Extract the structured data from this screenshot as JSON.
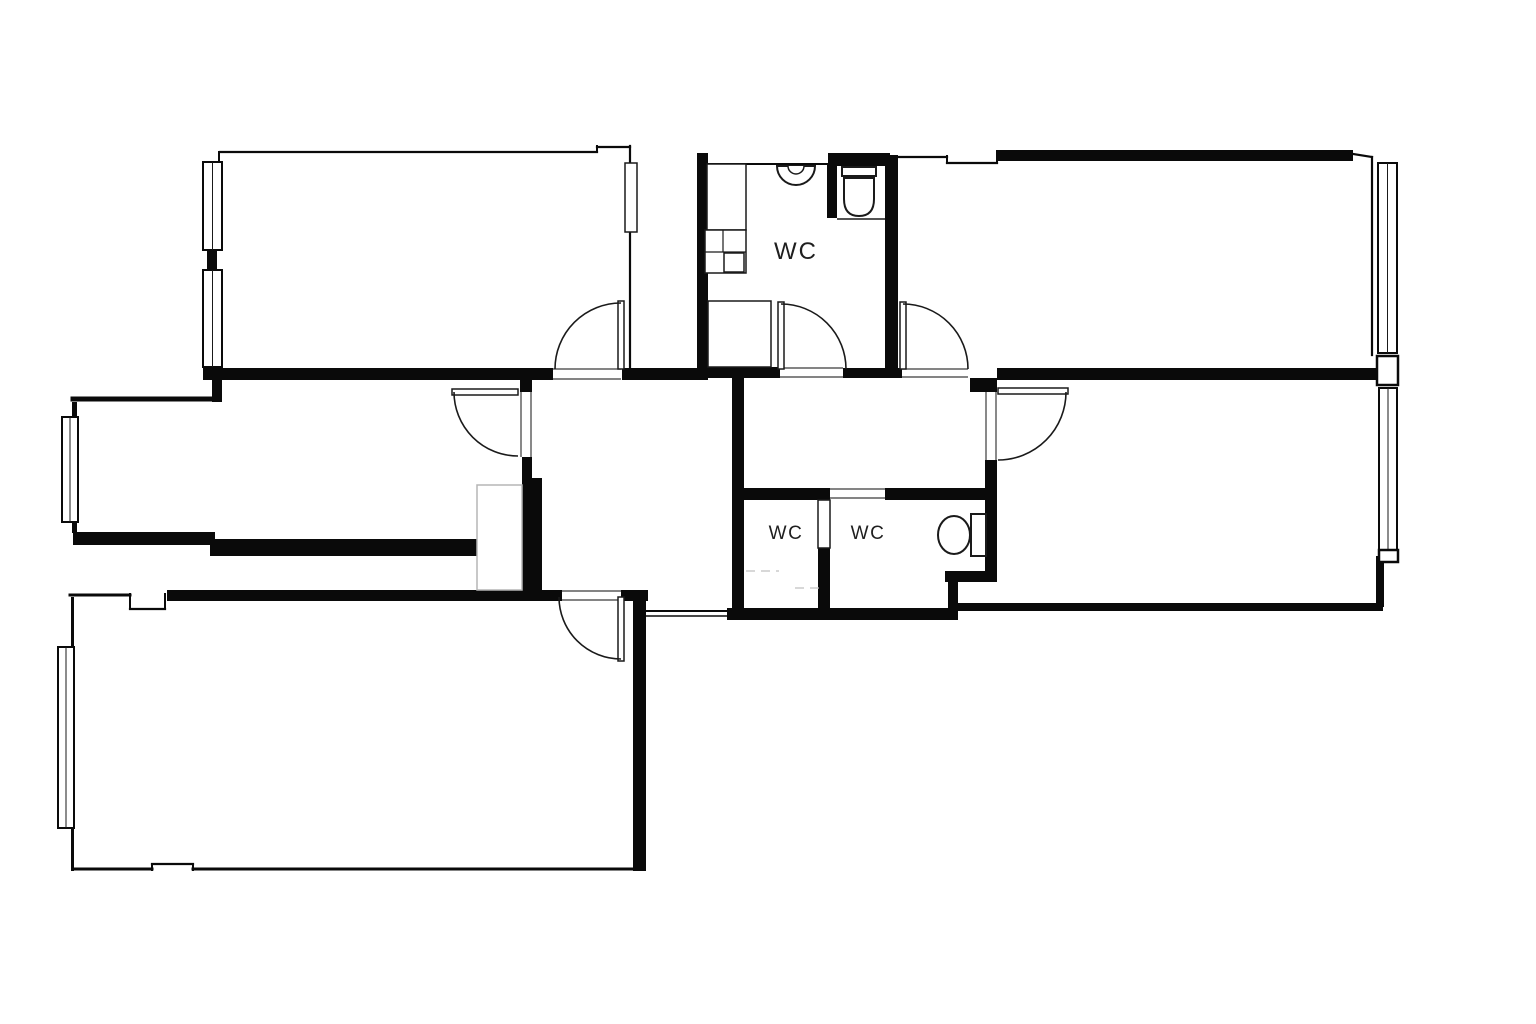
{
  "meta": {
    "title": "Apartment floor plan",
    "width": 1536,
    "height": 1024
  },
  "colors": {
    "ink": "#0a0a0a",
    "line": "#1a1a1a",
    "sill": "#3a3a3a",
    "faint": "#b5b5b5",
    "label": "#1f1f1f",
    "paper": "#ffffff"
  },
  "labels": [
    {
      "text": "WC",
      "x": 796,
      "y": 259,
      "size": 24,
      "ls": 2
    },
    {
      "text": "WC",
      "x": 786,
      "y": 539,
      "size": 19,
      "ls": 1.5
    },
    {
      "text": "WC",
      "x": 868,
      "y": 539,
      "size": 19,
      "ls": 1.5
    }
  ],
  "plan": {
    "walls": [
      [
        203,
        368,
        350,
        12
      ],
      [
        622,
        368,
        86,
        12
      ],
      [
        697,
        153,
        11,
        227
      ],
      [
        697,
        367,
        83,
        11
      ],
      [
        843,
        368,
        59,
        10
      ],
      [
        885,
        155,
        13,
        223
      ],
      [
        970,
        378,
        27,
        14
      ],
      [
        997,
        368,
        380,
        12
      ],
      [
        997,
        150,
        356,
        11
      ],
      [
        828,
        153,
        62,
        13
      ],
      [
        827,
        165,
        10,
        53
      ],
      [
        732,
        378,
        12,
        240
      ],
      [
        744,
        488,
        86,
        12
      ],
      [
        885,
        488,
        112,
        12
      ],
      [
        985,
        460,
        12,
        117
      ],
      [
        945,
        571,
        52,
        11
      ],
      [
        948,
        571,
        10,
        49
      ],
      [
        818,
        548,
        12,
        65
      ],
      [
        727,
        608,
        231,
        12
      ],
      [
        167,
        590,
        395,
        11
      ],
      [
        621,
        590,
        27,
        11
      ],
      [
        633,
        590,
        13,
        281
      ],
      [
        522,
        457,
        10,
        21
      ],
      [
        522,
        478,
        20,
        114
      ],
      [
        520,
        380,
        12,
        12
      ],
      [
        73,
        532,
        142,
        13
      ],
      [
        210,
        539,
        315,
        17
      ],
      [
        212,
        380,
        10,
        22
      ],
      [
        207,
        250,
        10,
        20
      ],
      [
        958,
        603,
        425,
        8
      ],
      [
        1376,
        556,
        8,
        51
      ],
      [
        215,
        367,
        7,
        13
      ],
      [
        72,
        402,
        5,
        15
      ],
      [
        72,
        522,
        5,
        11
      ],
      [
        71,
        597,
        3,
        50
      ],
      [
        71,
        827,
        3,
        44
      ]
    ],
    "lines": [
      [
        220,
        152,
        597,
        152,
        2.2
      ],
      [
        597,
        152,
        597,
        146,
        2
      ],
      [
        597,
        147,
        630,
        147,
        2.2
      ],
      [
        630,
        146,
        630,
        368,
        2.2
      ],
      [
        219,
        152,
        219,
        163,
        2
      ],
      [
        708,
        164,
        828,
        164,
        2
      ],
      [
        890,
        157,
        947,
        157,
        2.2
      ],
      [
        947,
        156,
        947,
        163,
        2
      ],
      [
        947,
        163,
        997,
        163,
        2.2
      ],
      [
        997,
        163,
        997,
        151,
        2
      ],
      [
        1353,
        154,
        1372,
        157,
        2.2
      ],
      [
        1372,
        157,
        1372,
        355,
        2.2
      ],
      [
        73,
        399,
        218,
        399,
        5
      ],
      [
        70,
        595,
        130,
        595,
        3
      ],
      [
        130,
        594,
        130,
        609,
        2
      ],
      [
        130,
        609,
        165,
        609,
        2.2
      ],
      [
        165,
        609,
        165,
        594,
        2
      ],
      [
        73,
        869,
        152,
        869,
        3
      ],
      [
        152,
        870,
        152,
        864,
        2
      ],
      [
        152,
        864,
        193,
        864,
        2.2
      ],
      [
        193,
        864,
        193,
        870,
        2
      ],
      [
        193,
        869,
        640,
        869,
        3
      ],
      [
        645,
        611,
        727,
        611,
        2
      ],
      [
        645,
        616,
        727,
        616,
        1.5
      ]
    ],
    "sills": [
      [
        553,
        369,
        621,
        369
      ],
      [
        553,
        379,
        621,
        379
      ],
      [
        780,
        368,
        843,
        368
      ],
      [
        780,
        377,
        843,
        377
      ],
      [
        902,
        369,
        968,
        369
      ],
      [
        902,
        377,
        968,
        377
      ],
      [
        521,
        392,
        521,
        457
      ],
      [
        531,
        392,
        531,
        457
      ],
      [
        986,
        392,
        986,
        460
      ],
      [
        996,
        392,
        996,
        460
      ],
      [
        562,
        591,
        621,
        591
      ],
      [
        562,
        600,
        621,
        600
      ],
      [
        830,
        489,
        885,
        489
      ],
      [
        830,
        498,
        885,
        498
      ]
    ],
    "windows": [
      {
        "x": 203,
        "y": 162,
        "w": 19,
        "h": 88
      },
      {
        "x": 203,
        "y": 270,
        "w": 19,
        "h": 97
      },
      {
        "x": 62,
        "y": 417,
        "w": 16,
        "h": 105
      },
      {
        "x": 58,
        "y": 647,
        "w": 16,
        "h": 181
      },
      {
        "x": 1378,
        "y": 163,
        "w": 19,
        "h": 190
      },
      {
        "x": 1379,
        "y": 388,
        "w": 18,
        "h": 162
      }
    ],
    "piers": [
      [
        1377,
        356,
        21,
        29
      ],
      [
        1379,
        550,
        19,
        12
      ]
    ],
    "door_arcs": [
      {
        "name": "door-arc-top-left-room",
        "d": "M 555 369 A 66 66 0 0 1 621 303"
      },
      {
        "name": "door-arc-top-bathroom",
        "d": "M 781 304 A 65 65 0 0 1 846 369"
      },
      {
        "name": "door-arc-top-right-room",
        "d": "M 903 304 A 65 65 0 0 1 968 369"
      },
      {
        "name": "door-arc-middle-left-room",
        "d": "M 454 392 A 64 64 0 0 0 518 456"
      },
      {
        "name": "door-arc-right-room",
        "d": "M 1066 392 A 68 68 0 0 1 998 460"
      },
      {
        "name": "door-arc-bottom-room",
        "d": "M 559 597 A 62 62 0 0 0 621 659"
      }
    ],
    "door_leaves": [
      {
        "name": "door-leaf-top-left-room",
        "x": 618,
        "y": 301,
        "w": 6,
        "h": 68
      },
      {
        "name": "door-leaf-top-bathroom",
        "x": 778,
        "y": 302,
        "w": 6,
        "h": 67
      },
      {
        "name": "door-leaf-top-right-room",
        "x": 900,
        "y": 302,
        "w": 6,
        "h": 67
      },
      {
        "name": "door-leaf-middle-left-room",
        "x": 452,
        "y": 389,
        "w": 66,
        "h": 6
      },
      {
        "name": "door-leaf-right-room",
        "x": 998,
        "y": 388,
        "w": 70,
        "h": 6
      },
      {
        "name": "door-leaf-bottom-room",
        "x": 618,
        "y": 597,
        "w": 6,
        "h": 64
      },
      {
        "name": "closet-door-leaf",
        "x": 625,
        "y": 163,
        "w": 12,
        "h": 69
      },
      {
        "name": "wc-door-leaf",
        "x": 818,
        "y": 500,
        "w": 12,
        "h": 48
      }
    ],
    "fixtures": [
      {
        "name": "washbasin",
        "kind": "path",
        "d": "M 777 166 A 19 19 0 0 0 815 166 Z",
        "sw": 2
      },
      {
        "name": "washbasin-inner",
        "kind": "path",
        "d": "M 788 166 A 8 8 0 0 0 804 166",
        "sw": 1.5
      },
      {
        "name": "toilet-cistern",
        "kind": "rect",
        "x": 842,
        "y": 167,
        "w": 34,
        "h": 9,
        "sw": 2
      },
      {
        "name": "toilet-bowl",
        "kind": "path",
        "d": "M 844 178 L 874 178 L 874 199 Q 874 216 859 216 Q 844 216 844 199 Z",
        "sw": 2
      },
      {
        "name": "niche-shelf",
        "kind": "line",
        "x1": 837,
        "y1": 219,
        "x2": 885,
        "y2": 219,
        "sw": 1.5
      },
      {
        "name": "shower-tray",
        "kind": "rect",
        "x": 708,
        "y": 301,
        "w": 63,
        "h": 66,
        "sw": 1.5
      },
      {
        "name": "bathroom-cabinet",
        "kind": "rect",
        "x": 707,
        "y": 164,
        "w": 39,
        "h": 66,
        "sw": 1.5
      },
      {
        "name": "cabinet-grid",
        "kind": "rect",
        "x": 705,
        "y": 230,
        "w": 41,
        "h": 43,
        "sw": 1.5
      },
      {
        "name": "cabinet-divider",
        "kind": "line",
        "x1": 723,
        "y1": 230,
        "x2": 723,
        "y2": 252,
        "sw": 1.2
      },
      {
        "name": "cabinet-divider",
        "kind": "line",
        "x1": 705,
        "y1": 252,
        "x2": 746,
        "y2": 252,
        "sw": 1.2
      },
      {
        "name": "cabinet-small-box",
        "kind": "rect",
        "x": 724,
        "y": 253,
        "w": 20,
        "h": 19,
        "sw": 1.5
      },
      {
        "name": "toilet2-cistern",
        "kind": "rect",
        "x": 971,
        "y": 514,
        "w": 15,
        "h": 42,
        "sw": 2
      },
      {
        "name": "toilet2-bowl",
        "kind": "ellipse",
        "cx": 954,
        "cy": 535,
        "rx": 16,
        "ry": 19,
        "sw": 2
      },
      {
        "name": "wardrobe",
        "kind": "rect",
        "x": 477,
        "y": 485,
        "w": 45,
        "h": 105,
        "sw": 1.5,
        "stroke": "#b5b5b5"
      },
      {
        "name": "floor-mark",
        "kind": "line",
        "x1": 746,
        "y1": 571,
        "x2": 779,
        "y2": 571,
        "sw": 1.2,
        "stroke": "#c0c0c0",
        "dash": "9 6"
      },
      {
        "name": "floor-mark",
        "kind": "line",
        "x1": 795,
        "y1": 588,
        "x2": 822,
        "y2": 588,
        "sw": 1.2,
        "stroke": "#c0c0c0",
        "dash": "9 6"
      }
    ]
  }
}
